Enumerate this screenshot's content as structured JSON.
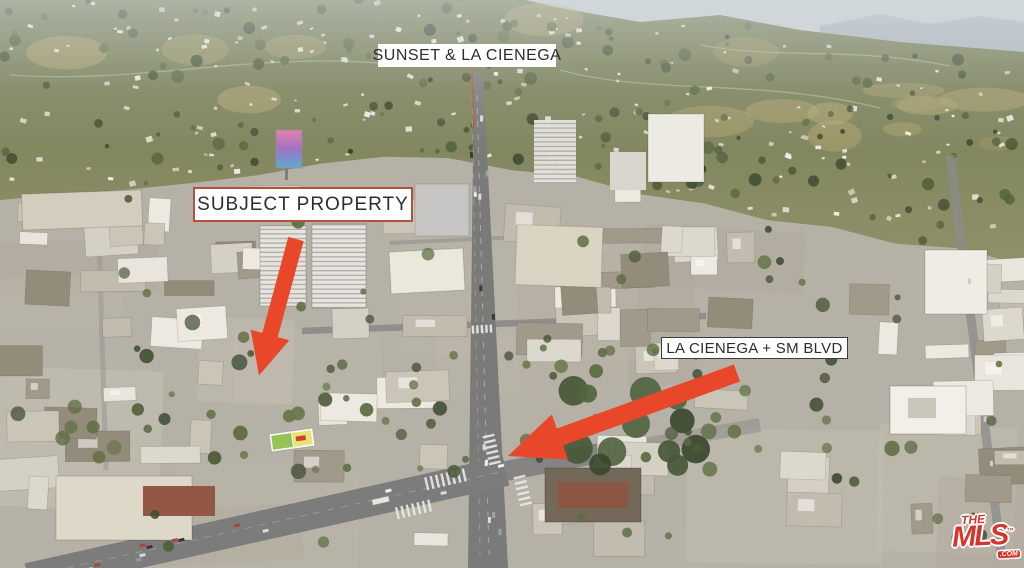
{
  "annotations": {
    "sunset": {
      "label": "SUNSET & LA CIENEGA"
    },
    "subject": {
      "label": "SUBJECT PROPERTY"
    },
    "sm_blvd": {
      "label": "LA CIENEGA + SM BLVD"
    }
  },
  "watermark": {
    "the": "THE",
    "mls": "MLS",
    "com": ".COM",
    "tm": "™"
  },
  "colors": {
    "arrow": "#e8472a",
    "subject_label_border": "#b3513f",
    "label_background": "#ffffff",
    "label_text": "#2d2d2d",
    "mls_red": "#d6352b"
  }
}
